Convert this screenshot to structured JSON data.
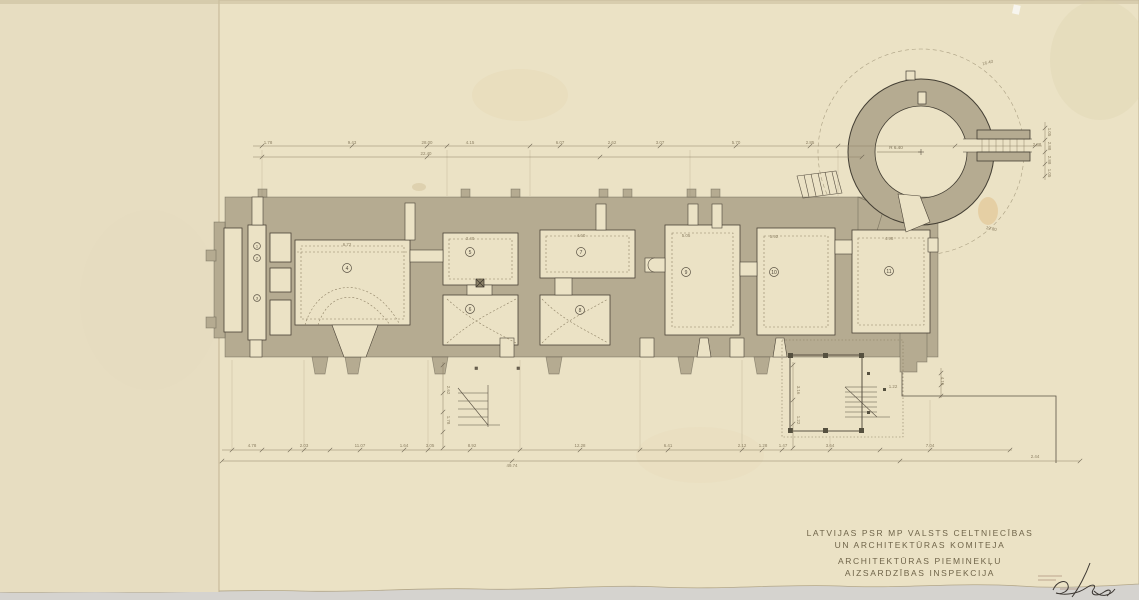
{
  "document": {
    "kind": "archival architectural floor plan (castle with round tower)",
    "organization_lines": [
      "LATVIJAS PSR MP VALSTS CELTNIECĪBAS",
      "UN ARCHITEKTŪRAS KOMITEJA",
      "ARCHITEKTŪRAS PIEMINEKĻU",
      "AIZSARDZĪBAS INSPEKCIJA"
    ]
  },
  "plan": {
    "room_numbers": [
      {
        "n": "1",
        "x": 257,
        "y": 246,
        "s": 3.4
      },
      {
        "n": "2",
        "x": 257,
        "y": 258,
        "s": 3.4
      },
      {
        "n": "3",
        "x": 257,
        "y": 298,
        "s": 3.4
      },
      {
        "n": "4",
        "x": 347,
        "y": 268,
        "s": 4.5
      },
      {
        "n": "5",
        "x": 470,
        "y": 252,
        "s": 4.5
      },
      {
        "n": "6",
        "x": 470,
        "y": 309,
        "s": 4.5
      },
      {
        "n": "7",
        "x": 581,
        "y": 252,
        "s": 4.5
      },
      {
        "n": "8",
        "x": 580,
        "y": 310,
        "s": 4.5
      },
      {
        "n": "9",
        "x": 686,
        "y": 272,
        "s": 4.5
      },
      {
        "n": "10",
        "x": 774,
        "y": 272,
        "s": 4.5
      },
      {
        "n": "11",
        "x": 889,
        "y": 271,
        "s": 4.5
      }
    ],
    "tower": {
      "radius_label": "R 6.40"
    },
    "dimension_labels": [
      {
        "t": "28.00",
        "x": 427,
        "y": 144,
        "r": 0
      },
      {
        "t": "22.40",
        "x": 426,
        "y": 155,
        "r": 0
      },
      {
        "t": "1.78",
        "x": 268,
        "y": 144,
        "r": 0
      },
      {
        "t": "9.43",
        "x": 352,
        "y": 144,
        "r": 0
      },
      {
        "t": "4.15",
        "x": 470,
        "y": 144,
        "r": 0
      },
      {
        "t": "6.07",
        "x": 560,
        "y": 144,
        "r": 0
      },
      {
        "t": "2.62",
        "x": 612,
        "y": 144,
        "r": 0
      },
      {
        "t": "3.07",
        "x": 660,
        "y": 144,
        "r": 0
      },
      {
        "t": "5.70",
        "x": 736,
        "y": 144,
        "r": 0
      },
      {
        "t": "2.85",
        "x": 810,
        "y": 144,
        "r": 0
      },
      {
        "t": "4.78",
        "x": 252,
        "y": 447,
        "r": 0
      },
      {
        "t": "2.03",
        "x": 304,
        "y": 447,
        "r": 0
      },
      {
        "t": "11.07",
        "x": 360,
        "y": 447,
        "r": 0
      },
      {
        "t": "1.64",
        "x": 404,
        "y": 447,
        "r": 0
      },
      {
        "t": "3.05",
        "x": 430,
        "y": 447,
        "r": 0
      },
      {
        "t": "8.92",
        "x": 472,
        "y": 447,
        "r": 0
      },
      {
        "t": "12.28",
        "x": 580,
        "y": 447,
        "r": 0
      },
      {
        "t": "6.41",
        "x": 668,
        "y": 447,
        "r": 0
      },
      {
        "t": "2.12",
        "x": 742,
        "y": 447,
        "r": 0
      },
      {
        "t": "1.28",
        "x": 763,
        "y": 447,
        "r": 0
      },
      {
        "t": "1.47",
        "x": 783,
        "y": 447,
        "r": 0
      },
      {
        "t": "3.64",
        "x": 830,
        "y": 447,
        "r": 0
      },
      {
        "t": "7.04",
        "x": 930,
        "y": 447,
        "r": 0
      },
      {
        "t": "2.44",
        "x": 1035,
        "y": 458,
        "r": 0
      },
      {
        "t": "49.74",
        "x": 512,
        "y": 467,
        "r": 0
      },
      {
        "t": "6.72",
        "x": 347,
        "y": 246,
        "r": 0
      },
      {
        "t": "3.40",
        "x": 470,
        "y": 240,
        "r": 0
      },
      {
        "t": "4.60",
        "x": 581,
        "y": 237,
        "r": 0
      },
      {
        "t": "5.05",
        "x": 686,
        "y": 237,
        "r": 0
      },
      {
        "t": "5.92",
        "x": 774,
        "y": 238,
        "r": 0
      },
      {
        "t": "4.98",
        "x": 889,
        "y": 240,
        "r": 0
      },
      {
        "t": "2.62",
        "x": 447,
        "y": 390,
        "r": 90
      },
      {
        "t": "1.78",
        "x": 447,
        "y": 420,
        "r": 90
      },
      {
        "t": "3.16",
        "x": 797,
        "y": 390,
        "r": 90
      },
      {
        "t": "1.22",
        "x": 797,
        "y": 420,
        "r": 90
      },
      {
        "t": "4.15",
        "x": 941,
        "y": 381,
        "r": 90
      },
      {
        "t": "1.05",
        "x": 1048,
        "y": 132,
        "r": 90
      },
      {
        "t": "2.88",
        "x": 1048,
        "y": 146,
        "r": 90
      },
      {
        "t": "2.88",
        "x": 1048,
        "y": 160,
        "r": 90
      },
      {
        "t": "1.05",
        "x": 1048,
        "y": 173,
        "r": 90
      },
      {
        "t": "16.40",
        "x": 988,
        "y": 64,
        "r": -14
      },
      {
        "t": "19.80",
        "x": 991,
        "y": 230,
        "r": 12
      },
      {
        "t": "1.22",
        "x": 893,
        "y": 388,
        "r": 0
      },
      {
        "t": "2.88",
        "x": 1037,
        "y": 146,
        "r": 0
      }
    ]
  }
}
